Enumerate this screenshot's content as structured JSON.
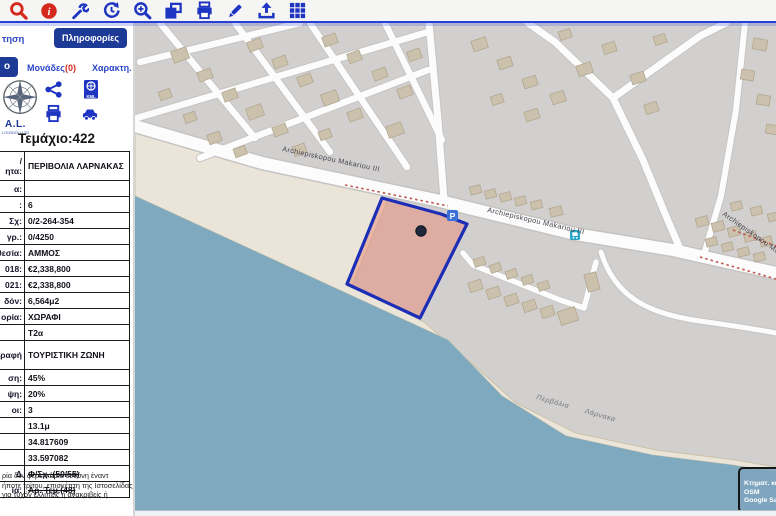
{
  "toolbar": {
    "icons": [
      {
        "name": "search",
        "color": "#d4291d"
      },
      {
        "name": "info",
        "color": "#d4291d"
      },
      {
        "name": "wrench",
        "color": "#1e35c2"
      },
      {
        "name": "history",
        "color": "#1e35c2"
      },
      {
        "name": "zoom-in",
        "color": "#1e35c2"
      },
      {
        "name": "copy",
        "color": "#1e35c2"
      },
      {
        "name": "print",
        "color": "#1e35c2"
      },
      {
        "name": "edit",
        "color": "#1e35c2"
      },
      {
        "name": "upload",
        "color": "#1e35c2"
      },
      {
        "name": "grid",
        "color": "#1e35c2"
      }
    ]
  },
  "sidebar": {
    "tabs_row1": {
      "left_partial": "τηση",
      "active": "Πληροφορίες"
    },
    "tabs_row2": {
      "left_partial": "ο",
      "units_label": "Μονάδες",
      "units_count": "(0)",
      "char_label": "Χαρακτη."
    },
    "logo": {
      "text": "A.L.",
      "subtext": "LOIZIDOU LTD"
    },
    "kml_label": "KML",
    "title": "Τεμάχιο:422",
    "table": {
      "rows": [
        {
          "label": "/\nητα:",
          "value": "ΠΕΡΙΒΟΛΙΑ ΛΑΡΝΑΚΑΣ",
          "tall": true
        },
        {
          "label": "α:",
          "value": ""
        },
        {
          "label": ":",
          "value": "6"
        },
        {
          "label": "Σχ:",
          "value": "0/2-264-354",
          "download": true
        },
        {
          "label": "γρ.:",
          "value": "0/4250"
        },
        {
          "label": "θεσία:",
          "value": "ΑΜΜΟΣ"
        },
        {
          "label": "018:",
          "value": "€2,338,800"
        },
        {
          "label": "021:",
          "value": "€2,338,800"
        },
        {
          "label": "δόν:",
          "value": "6,564μ2"
        },
        {
          "label": "ορία:",
          "value": "ΧΩΡΑΦΙ"
        },
        {
          "label": "",
          "value": "T2α"
        },
        {
          "label": "ραφή",
          "value": "ΤΟΥΡΙΣΤΙΚΗ ΖΩΝΗ",
          "tall": true
        },
        {
          "label": "ση:",
          "value": "45%"
        },
        {
          "label": "ψη:",
          "value": "20%"
        },
        {
          "label": "οι:",
          "value": "3"
        },
        {
          "label": "",
          "value": "13.1μ"
        },
        {
          "label": "",
          "value": "34.817609"
        },
        {
          "label": "",
          "value": "33.597082"
        },
        {
          "label": "Δ",
          "value": "Φ/Σχ.:(50/55)",
          "strike": true
        },
        {
          "label": "ία:",
          "value": "Αρ. Τεμ.(48)",
          "strike": true
        }
      ]
    },
    "disclaimer_lines": [
      "ρία δεν φέρει καμία ευθύνη έναντ",
      "ήποτε τρίτου, επισκέπτη της Ιστοσελίδας",
      "για τυχόν ελλιπείς ή ανακριβείς ή"
    ]
  },
  "map": {
    "street_label": "Archiepiskopou Makariou III",
    "beach_label": "Περβόλια Λάρνακα",
    "parking_symbol": "P",
    "layer_box": {
      "items": [
        "Κτηματ. κα",
        "OSM",
        "Google Sa"
      ]
    },
    "colors": {
      "sea": "#7fa9be",
      "beach": "#eae5d8",
      "land": "#d2d0cf",
      "building": "#cbc1ad",
      "parcel_fill": "#e78a78",
      "parcel_border": "#1c2eb5",
      "boundary": "#c0564c",
      "road": "#fcfcfc",
      "toolbar_red": "#d4291d",
      "toolbar_blue": "#1e35c2",
      "accent_navy": "#1d3a96"
    }
  }
}
